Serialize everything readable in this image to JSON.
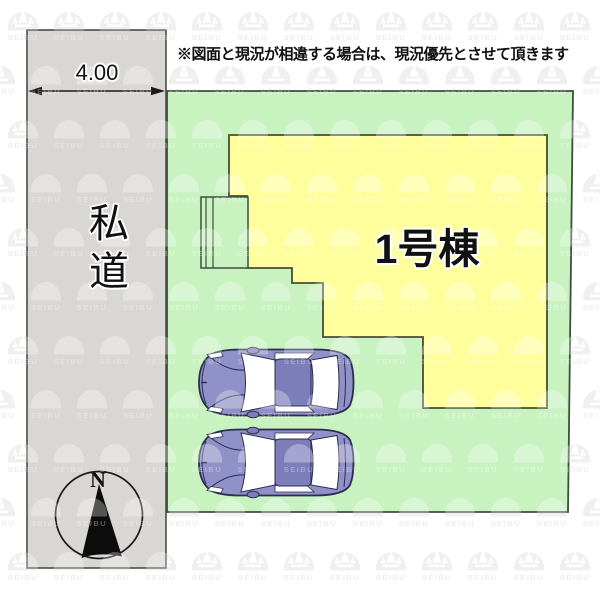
{
  "disclaimer": "※図面と現況が相違する場合は、現況優先とさせて頂きます",
  "road": {
    "label": "私道",
    "width_label": "4.00"
  },
  "building": {
    "label": "1号棟"
  },
  "compass": {
    "north_label": "N"
  },
  "watermark": {
    "text": "SEIBU"
  },
  "colors": {
    "road_fill": "#d9d7d3",
    "road_border": "#4b4b4b",
    "plot_fill": "#c9f2c1",
    "plot_border": "#3f4d3f",
    "building_fill": "#feff9c",
    "building_border": "#4a4a35",
    "car_body": "#9191c9",
    "car_roof": "#7d7dba",
    "car_window": "#ffffff",
    "car_outline": "#2c2c50",
    "ink": "#1a1a1a",
    "watermark_gray": "#e9e9e9"
  }
}
